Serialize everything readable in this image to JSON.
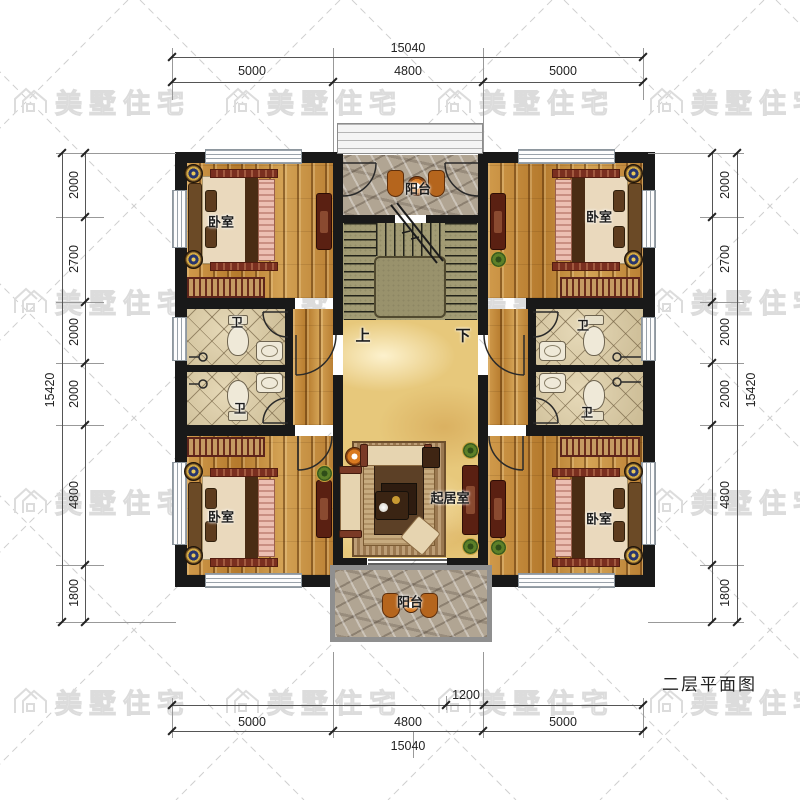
{
  "watermark": {
    "text": "美墅住宅"
  },
  "title": "二层平面图",
  "rooms": {
    "bedroom": "卧室",
    "bathroom": "卫",
    "balcony": "阳台",
    "living_room": "起居室",
    "stair_up": "上",
    "stair_down": "下"
  },
  "dimensions": {
    "top": {
      "total": "15040",
      "segments": [
        "5000",
        "4800",
        "5000"
      ]
    },
    "bottom": {
      "balcony_width": "1200",
      "segments": [
        "5000",
        "4800",
        "5000"
      ],
      "total": "15040"
    },
    "left": {
      "segments": [
        "2000",
        "2700",
        "2000",
        "2000",
        "4800",
        "1800"
      ],
      "total": "15420"
    },
    "right": {
      "segments": [
        "2000",
        "2700",
        "2000",
        "2000",
        "4800",
        "1800"
      ],
      "total": "15420"
    }
  },
  "colors": {
    "wall": "#191919",
    "wood": "#c08538",
    "tile": "#dccda9",
    "stone": "#b1a593",
    "marble": "#e7c87b",
    "stair": "#a29b74",
    "accent_red": "#6b2c1c"
  }
}
